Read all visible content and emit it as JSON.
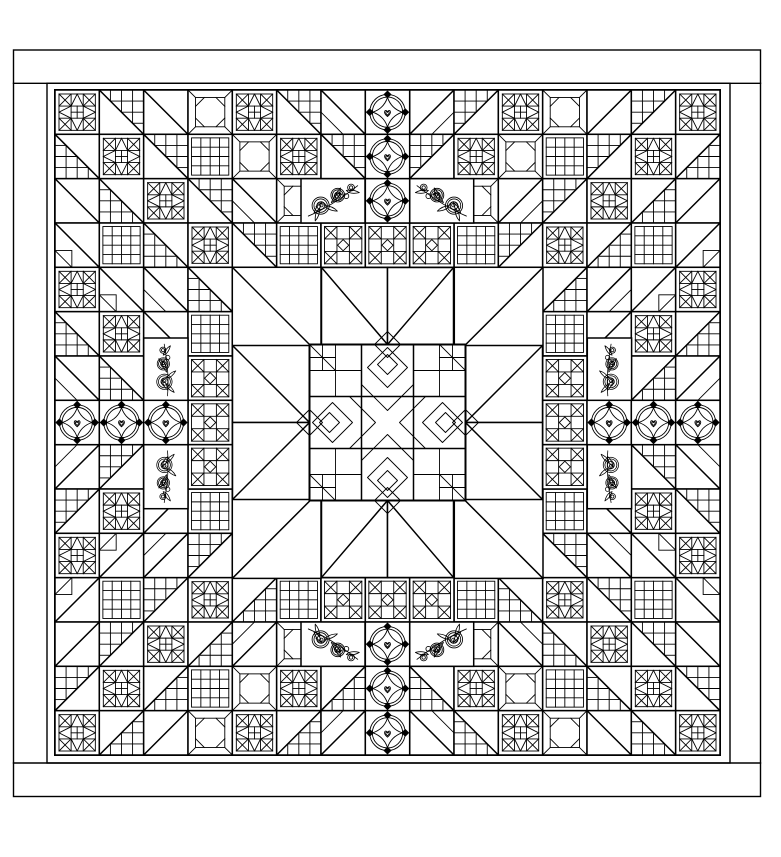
{
  "canvas": {
    "width": 781,
    "height": 857,
    "paper": "#ffffff",
    "ink": "#000000"
  },
  "strokes": {
    "frame": 1.4,
    "block": 1.5,
    "detail": 0.9,
    "heavy": 2.0
  },
  "frame": {
    "outer": {
      "x": 13.5,
      "y": 50,
      "w": 747,
      "h": 746.5
    },
    "top_rule_y": 83.3,
    "bottom_rule_y": 763,
    "inner": {
      "x": 47,
      "y": 83.3,
      "w": 683,
      "h": 679.7
    },
    "field": {
      "x": 55,
      "y": 90,
      "w": 665,
      "h": 665
    }
  },
  "grid": {
    "rows": 15,
    "cols": 15
  },
  "pattern": {
    "diagonal_cycle": [
      "star",
      "half-square-grid",
      "half-square",
      "corner-square"
    ],
    "symmetry": "fourfold-mirror",
    "diagonals": {
      "top_left": "backslash",
      "top_right": "slash",
      "bottom_left": "slash",
      "bottom_right": "backslash"
    }
  },
  "features": {
    "medallion": {
      "cx": 387.5,
      "cy": 422.5,
      "size": 156
    },
    "wreath_cells": [
      [
        0,
        7
      ],
      [
        1,
        7
      ],
      [
        2,
        7
      ],
      [
        7,
        0
      ],
      [
        7,
        1
      ],
      [
        7,
        2
      ],
      [
        7,
        12
      ],
      [
        7,
        13
      ],
      [
        7,
        14
      ],
      [
        12,
        7
      ],
      [
        13,
        7
      ],
      [
        14,
        7
      ]
    ],
    "chain_cells": [
      [
        3,
        6
      ],
      [
        3,
        7
      ],
      [
        3,
        8
      ],
      [
        11,
        6
      ],
      [
        11,
        7
      ],
      [
        11,
        8
      ],
      [
        6,
        3
      ],
      [
        7,
        3
      ],
      [
        8,
        3
      ],
      [
        6,
        11
      ],
      [
        7,
        11
      ],
      [
        8,
        11
      ]
    ],
    "corner_triangles": [
      {
        "x": 232.3,
        "y": 267.3,
        "w": 88.7,
        "h": 88.7,
        "d": "bslash"
      },
      {
        "x": 454.3,
        "y": 267.3,
        "w": 88.7,
        "h": 88.7,
        "d": "slash"
      },
      {
        "x": 232.3,
        "y": 489.7,
        "w": 88.7,
        "h": 88.7,
        "d": "slash"
      },
      {
        "x": 454.3,
        "y": 489.7,
        "w": 88.7,
        "h": 88.7,
        "d": "bslash"
      }
    ],
    "ray_triangles": [
      {
        "x": 321.5,
        "y": 267.5,
        "w": 66,
        "h": 77,
        "d": "bslash"
      },
      {
        "x": 387.5,
        "y": 267.5,
        "w": 66,
        "h": 77,
        "d": "slash"
      },
      {
        "x": 321.5,
        "y": 500.5,
        "w": 66,
        "h": 77,
        "d": "slash"
      },
      {
        "x": 387.5,
        "y": 500.5,
        "w": 66,
        "h": 77,
        "d": "bslash"
      },
      {
        "x": 232.5,
        "y": 345.5,
        "w": 77,
        "h": 77,
        "d": "bslash"
      },
      {
        "x": 232.5,
        "y": 422.5,
        "w": 77,
        "h": 77,
        "d": "slash"
      },
      {
        "x": 465.5,
        "y": 345.5,
        "w": 77,
        "h": 77,
        "d": "slash"
      },
      {
        "x": 465.5,
        "y": 422.5,
        "w": 77,
        "h": 77,
        "d": "bslash"
      }
    ],
    "rose_sprays": [
      {
        "x": 301,
        "y": 178.7,
        "w": 64,
        "h": 44.3,
        "rot": 0,
        "sx": 1,
        "sy": 1,
        "k": 0.95
      },
      {
        "x": 409.7,
        "y": 178.7,
        "w": 64,
        "h": 44.3,
        "rot": 0,
        "sx": -1,
        "sy": 1,
        "k": 0.95
      },
      {
        "x": 301,
        "y": 622,
        "w": 64,
        "h": 44.3,
        "rot": 0,
        "sx": 1,
        "sy": -1,
        "k": 0.95
      },
      {
        "x": 409.7,
        "y": 622,
        "w": 64,
        "h": 44.3,
        "rot": 0,
        "sx": -1,
        "sy": -1,
        "k": 0.95
      },
      {
        "x": 143.7,
        "y": 338,
        "w": 44.3,
        "h": 64,
        "rot": -62,
        "sx": 1,
        "sy": 1,
        "k": 0.85
      },
      {
        "x": 143.7,
        "y": 444.7,
        "w": 44.3,
        "h": 64,
        "rot": -62,
        "sx": 1,
        "sy": -1,
        "k": 0.85
      },
      {
        "x": 587.3,
        "y": 338,
        "w": 44.3,
        "h": 64,
        "rot": -62,
        "sx": -1,
        "sy": 1,
        "k": 0.85
      },
      {
        "x": 587.3,
        "y": 444.7,
        "w": 44.3,
        "h": 64,
        "rot": -62,
        "sx": -1,
        "sy": -1,
        "k": 0.85
      }
    ]
  }
}
